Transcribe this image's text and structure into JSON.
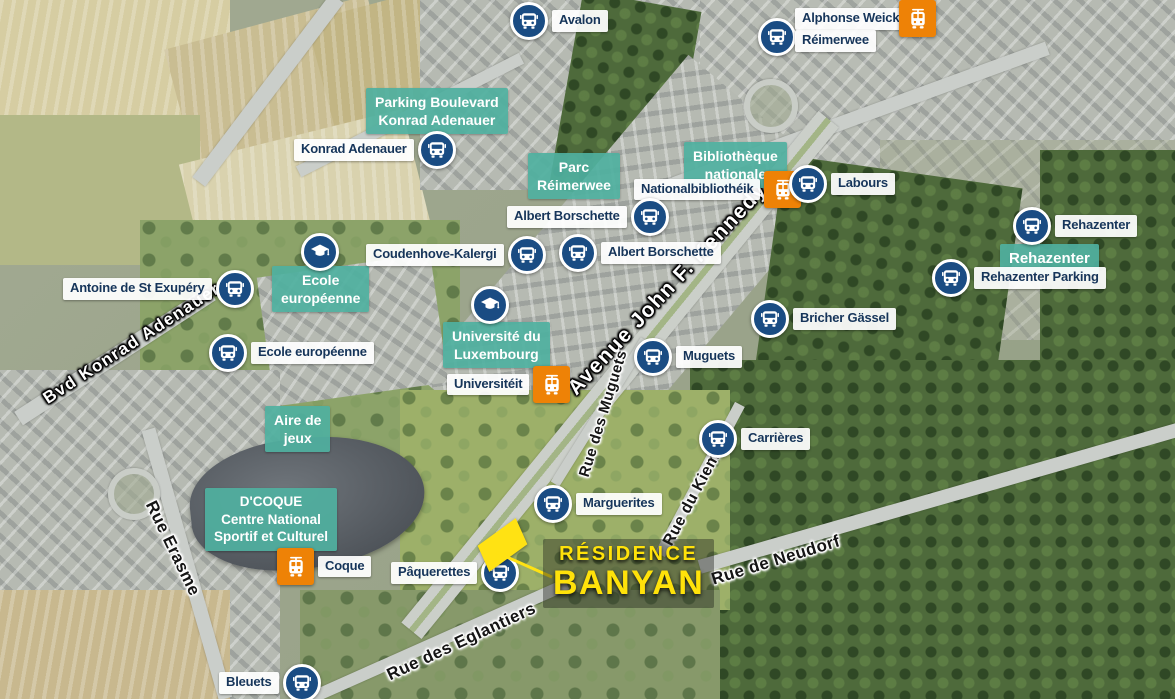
{
  "residence": {
    "line1": "RÉSIDENCE",
    "line2": "BANYAN"
  },
  "streets": {
    "kennedy": "Avenue John F. Kennedy",
    "konrad": "Bvd Konrad Adenauer",
    "erasme": "Rue Erasme",
    "muguets": "Rue des Muguets",
    "kiem": "Rue du Kiem",
    "neudorf": "Rue de Neudorf",
    "eglantiers": "Rue des Eglantiers"
  },
  "pois": {
    "parking": {
      "l1": "Parking Boulevard",
      "l2": "Konrad Adenauer"
    },
    "parc": {
      "l1": "Parc",
      "l2": "Réimerwee"
    },
    "biblio": {
      "l1": "Bibliothèque",
      "l2": "nationale"
    },
    "rehazenter": {
      "l1": "Rehazenter"
    },
    "ecole": {
      "l1": "Ecole",
      "l2": "européenne"
    },
    "uni": {
      "l1": "Université du",
      "l2": "Luxembourg"
    },
    "aire": {
      "l1": "Aire de",
      "l2": "jeux"
    },
    "coque": {
      "l1": "D'COQUE",
      "l2": "Centre National",
      "l3": "Sportif et Culturel"
    }
  },
  "stops": {
    "avalon": "Avalon",
    "alphonse_weicker": "Alphonse Weicker",
    "reimerwee": "Réimerwee",
    "konrad_adenauer": "Konrad Adenauer",
    "nationalbibliothek": "Nationalbibliothéik",
    "labours": "Labours",
    "albert_borschette_1": "Albert Borschette",
    "rehazenter": "Rehazenter",
    "rehazenter_parking": "Rehazenter Parking",
    "coudenhove_kalergi": "Coudenhove-Kalergi",
    "albert_borschette_2": "Albert Borschette",
    "antoine": "Antoine de St Exupéry",
    "ecole_europeenne": "Ecole européenne",
    "universiteit": "Universitéit",
    "bricher_gassel": "Bricher Gässel",
    "muguets": "Muguets",
    "carrieres": "Carrières",
    "marguerites": "Marguerites",
    "coque": "Coque",
    "paquerettes": "Pâquerettes",
    "bleuets": "Bleuets"
  },
  "icons": {
    "bus": "bus-icon",
    "tram": "tram-icon",
    "school": "graduation-cap-icon",
    "site": "site-marker"
  },
  "colors": {
    "bus_blue": "#1a4c83",
    "tram_orange": "#ee8206",
    "poi_teal": "#4fb0a0",
    "label_navy": "#16355a",
    "banyan_yellow": "#ffe20a",
    "street_white": "#ffffff",
    "street_dark": "#151515"
  }
}
